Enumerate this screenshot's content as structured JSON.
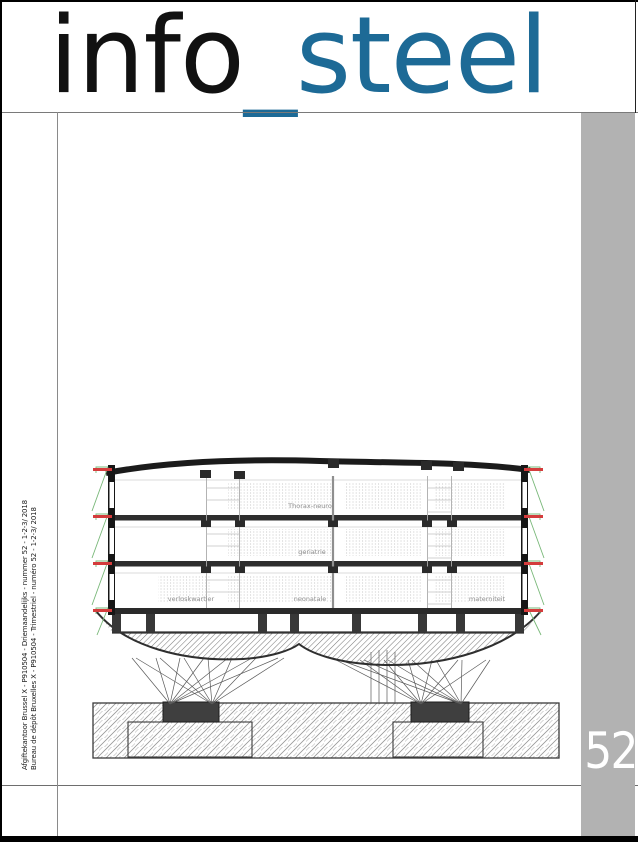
{
  "masthead": {
    "title_primary": "info",
    "title_separator": "_",
    "title_accent": "steel",
    "accent_color": "#1d6a96"
  },
  "issue": {
    "number": "52"
  },
  "spine": {
    "line1": "Afgiftekantoor Brussel X - P910504 - Driemaandelijks - nummer 52 - 1-2-3/ 2018",
    "line2": "Bureau de dépôt Bruxelles X - P910504 - Trimestriel - numéro 52 - 1-2-3/ 2018"
  },
  "drawing": {
    "labels": {
      "level1": "Thorax-neuro",
      "level2": "geriatrie",
      "level3_left": "verloskwartier",
      "level3_center": "neonatale",
      "level3_right": "materniteit"
    }
  },
  "colors": {
    "rail_gray": "#b2b2b2",
    "marker_red": "#d43c3c",
    "marker_green": "#79b879",
    "issue_text": "#ffffff"
  }
}
